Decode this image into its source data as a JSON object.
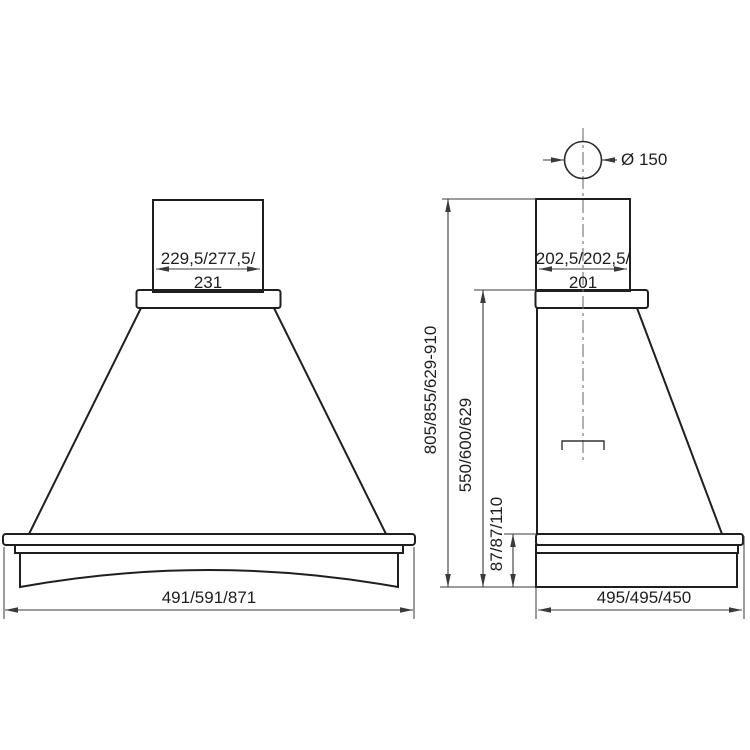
{
  "drawing": {
    "type": "technical-dimension-drawing",
    "subject": "range hood, front and side elevations",
    "front_view": {
      "chimney_width_line1": "229,5/277,5/",
      "chimney_width_line2": "231",
      "body_width": "491/591/871"
    },
    "side_view": {
      "duct_diameter": "Ø 150",
      "chimney_depth_line1": "202,5/202,5/",
      "chimney_depth_line2": "201",
      "total_height": "805/855/629-910",
      "hood_height": "550/600/629",
      "base_height": "87/87/110",
      "body_depth": "495/495/450"
    }
  },
  "colors": {
    "wood_trim": "#ebdfc2",
    "outline": "#1f1f1f",
    "dimension": "#3a3a3a",
    "metal_top": "#f2f2f2",
    "metal_bottom": "#a9a9ae",
    "hood_front_top": "#ffffff",
    "hood_front_bottom": "#c8c8cd",
    "hood_side_top": "#f1f1f3",
    "hood_side_bottom": "#cfcfd3"
  }
}
